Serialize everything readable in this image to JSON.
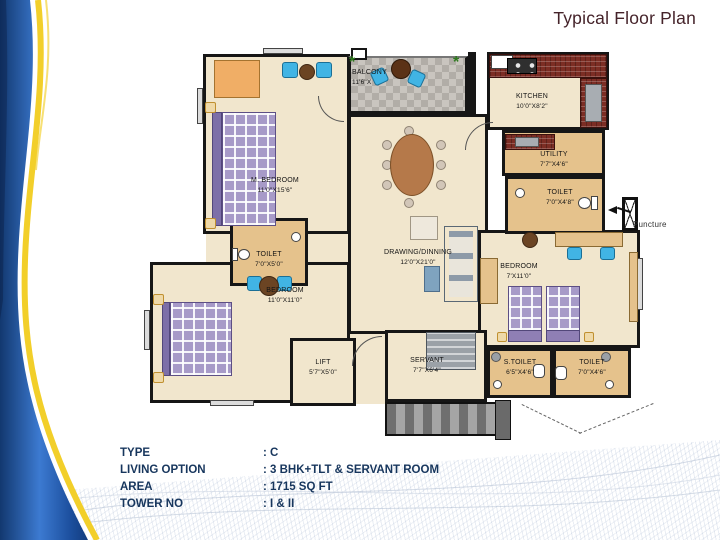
{
  "slide": {
    "title": "Typical Floor Plan"
  },
  "specs": {
    "rows": [
      {
        "label": "TYPE",
        "value": ": C"
      },
      {
        "label": "LIVING OPTION",
        "value": ": 3 BHK+TLT & SERVANT ROOM"
      },
      {
        "label": "AREA",
        "value": ": 1715 SQ FT"
      },
      {
        "label": "TOWER NO",
        "value": ": I & II"
      }
    ]
  },
  "plan": {
    "rooms": [
      {
        "name": "M. BEDROOM",
        "dim": "11'0\"X15'6\""
      },
      {
        "name": "BALCONY",
        "dim": "11'6\"X"
      },
      {
        "name": "KITCHEN",
        "dim": "10'0\"X8'2\""
      },
      {
        "name": "UTILITY",
        "dim": "7'7\"X4'6\""
      },
      {
        "name": "TOILET",
        "dim": "7'0\"X4'8\""
      },
      {
        "name": "DRAWING/DINNING",
        "dim": "12'0\"X21'0\""
      },
      {
        "name": "TOILET",
        "dim": "7'0\"X5'0\""
      },
      {
        "name": "BEDROOM",
        "dim": "11'0\"X11'0\""
      },
      {
        "name": "BEDROOM",
        "dim": "7'X11'0\""
      },
      {
        "name": "LIFT",
        "dim": "5'7\"X5'0\""
      },
      {
        "name": "SERVANT",
        "dim": "7'7\"X6'4\""
      },
      {
        "name": "S.TOILET",
        "dim": "6'5\"X4'6\""
      },
      {
        "name": "TOILET",
        "dim": "7'0\"X4'6\""
      }
    ],
    "annotations": {
      "puncture": "Puncture"
    }
  },
  "colors": {
    "swoosh_blue": "#2e6cbe",
    "swoosh_yellow": "#f2cf2a",
    "wall": "#161616",
    "floor_cream": "#f1e6cd",
    "floor_tan": "#e5c28c",
    "counter_brick": "#7c2d24",
    "accent_chair_blue": "#41b4e4",
    "bed_lavender": "#a79ac8",
    "title_text": "#45232a",
    "spec_text": "#17365d"
  }
}
